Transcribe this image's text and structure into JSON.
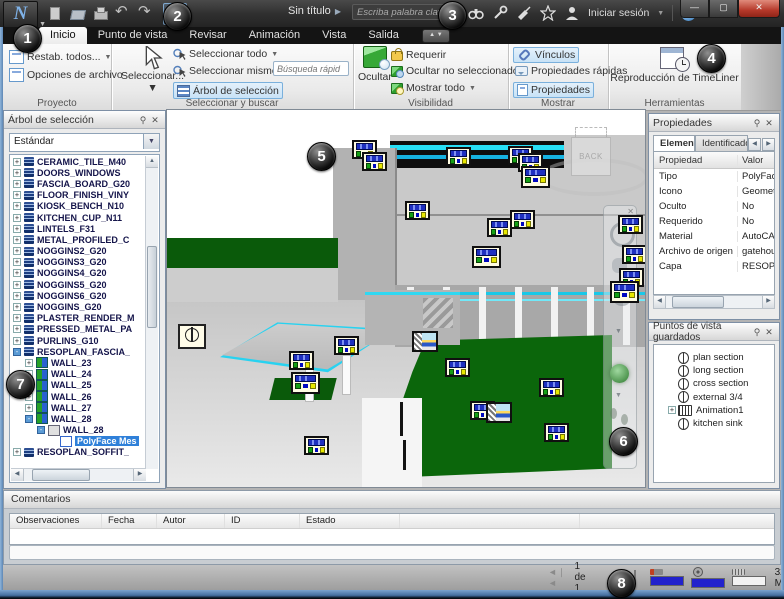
{
  "window": {
    "app_letter": "N"
  },
  "title_bar": {
    "doc_title": "Sin título",
    "search_placeholder": "Escriba palabra clave o frase",
    "sign_in_label": "Iniciar sesión",
    "qat_icons": [
      "new-file",
      "open-file",
      "print",
      "undo",
      "redo"
    ],
    "right_icons": [
      "binoculars",
      "wrench",
      "satellite",
      "star",
      "user",
      "help"
    ]
  },
  "ribbon": {
    "tabs": [
      "Inicio",
      "Punto de vista",
      "Revisar",
      "Animación",
      "Vista",
      "Salida"
    ],
    "active_tab": "Inicio",
    "proyecto": {
      "title": "Proyecto",
      "restab": "Restab. todos...",
      "opciones": "Opciones de archivo"
    },
    "seleccionar": {
      "title": "Seleccionar y buscar",
      "big": "Seleccionar...",
      "todo": "Seleccionar todo",
      "mismo": "Seleccionar mismo",
      "busqueda_placeholder": "Búsqueda rápid",
      "arbol": "Árbol de selección"
    },
    "visibilidad": {
      "title": "Visibilidad",
      "ocultar": "Ocultar",
      "requerir": "Requerir",
      "ocultar_no": "Ocultar no seleccionados",
      "mostrar_todo": "Mostrar todo"
    },
    "mostrar": {
      "title": "Mostrar",
      "vinculos": "Vínculos",
      "prop_rapidas": "Propiedades rápidas",
      "propiedades": "Propiedades"
    },
    "herramientas": {
      "title": "Herramientas",
      "timeliner": "Reproducción de TimeLiner"
    }
  },
  "selection_tree": {
    "title": "Árbol de selección",
    "combo_value": "Estándar",
    "items": [
      {
        "label": "CERAMIC_TILE_M40",
        "level": 1,
        "exp": "+",
        "icon": "layer"
      },
      {
        "label": "DOORS_WINDOWS",
        "level": 1,
        "exp": "+",
        "icon": "layer"
      },
      {
        "label": "FASCIA_BOARD_G20",
        "level": 1,
        "exp": "+",
        "icon": "layer"
      },
      {
        "label": "FLOOR_FINISH_VINY",
        "level": 1,
        "exp": "+",
        "icon": "layer"
      },
      {
        "label": "KIOSK_BENCH_N10",
        "level": 1,
        "exp": "+",
        "icon": "layer"
      },
      {
        "label": "KITCHEN_CUP_N11",
        "level": 1,
        "exp": "+",
        "icon": "layer"
      },
      {
        "label": "LINTELS_F31",
        "level": 1,
        "exp": "+",
        "icon": "layer"
      },
      {
        "label": "METAL_PROFILED_C",
        "level": 1,
        "exp": "+",
        "icon": "layer"
      },
      {
        "label": "NOGGINS2_G20",
        "level": 1,
        "exp": "+",
        "icon": "layer"
      },
      {
        "label": "NOGGINS3_G20",
        "level": 1,
        "exp": "+",
        "icon": "layer"
      },
      {
        "label": "NOGGINS4_G20",
        "level": 1,
        "exp": "+",
        "icon": "layer"
      },
      {
        "label": "NOGGINS5_G20",
        "level": 1,
        "exp": "+",
        "icon": "layer"
      },
      {
        "label": "NOGGINS6_G20",
        "level": 1,
        "exp": "+",
        "icon": "layer"
      },
      {
        "label": "NOGGINS_G20",
        "level": 1,
        "exp": "+",
        "icon": "layer"
      },
      {
        "label": "PLASTER_RENDER_M",
        "level": 1,
        "exp": "+",
        "icon": "layer"
      },
      {
        "label": "PRESSED_METAL_PA",
        "level": 1,
        "exp": "+",
        "icon": "layer"
      },
      {
        "label": "PURLINS_G10",
        "level": 1,
        "exp": "+",
        "icon": "layer"
      },
      {
        "label": "RESOPLAN_FASCIA_",
        "level": 1,
        "exp": "-",
        "icon": "layer"
      },
      {
        "label": "WALL_23",
        "level": 2,
        "exp": "+",
        "icon": "wall"
      },
      {
        "label": "WALL_24",
        "level": 2,
        "exp": "+",
        "icon": "wall"
      },
      {
        "label": "WALL_25",
        "level": 2,
        "exp": "+",
        "icon": "wall"
      },
      {
        "label": "WALL_26",
        "level": 2,
        "exp": "+",
        "icon": "wall"
      },
      {
        "label": "WALL_27",
        "level": 2,
        "exp": "+",
        "icon": "wall"
      },
      {
        "label": "WALL_28",
        "level": 2,
        "exp": "-",
        "icon": "wall"
      },
      {
        "label": "WALL_28",
        "level": 3,
        "exp": "-",
        "icon": "group",
        "bold": true
      },
      {
        "label": "PolyFace Mes",
        "level": 4,
        "exp": "",
        "icon": "geom",
        "sel": true
      },
      {
        "label": "RESOPLAN_SOFFIT_",
        "level": 1,
        "exp": "+",
        "icon": "layer"
      }
    ]
  },
  "properties": {
    "title": "Propiedades",
    "tabs": [
      "Elemento",
      "Identificador d"
    ],
    "columns": [
      "Propiedad",
      "Valor"
    ],
    "rows": [
      [
        "Tipo",
        "PolyFace M"
      ],
      [
        "Icono",
        "Geometría"
      ],
      [
        "Oculto",
        "No"
      ],
      [
        "Requerido",
        "No"
      ],
      [
        "Material",
        "AutoCAD C"
      ],
      [
        "Archivo de origen",
        "gatehouse"
      ],
      [
        "Capa",
        "RESOPLA"
      ]
    ]
  },
  "viewpoints": {
    "title": "Puntos de vista guardados",
    "items": [
      {
        "label": "plan section",
        "icon": "viewpoint",
        "exp": ""
      },
      {
        "label": "long section",
        "icon": "viewpoint",
        "exp": ""
      },
      {
        "label": "cross section",
        "icon": "viewpoint",
        "exp": ""
      },
      {
        "label": "external 3/4",
        "icon": "viewpoint",
        "exp": ""
      },
      {
        "label": "Animation1",
        "icon": "animation",
        "exp": "+"
      },
      {
        "label": "kitchen sink",
        "icon": "viewpoint",
        "exp": ""
      }
    ]
  },
  "comments": {
    "title": "Comentarios",
    "columns": [
      "Observaciones",
      "Fecha",
      "Autor",
      "ID",
      "Estado"
    ]
  },
  "status_bar": {
    "page": "1 de 1",
    "memory": "324 MB"
  },
  "viewport": {
    "viewcube_face": "BACK",
    "link_icons": [
      {
        "x": 352,
        "y": 140,
        "t": "link"
      },
      {
        "x": 362,
        "y": 152,
        "t": "link"
      },
      {
        "x": 446,
        "y": 147,
        "t": "link"
      },
      {
        "x": 508,
        "y": 146,
        "t": "link"
      },
      {
        "x": 518,
        "y": 153,
        "t": "link"
      },
      {
        "x": 521,
        "y": 166,
        "t": "link",
        "big": true
      },
      {
        "x": 405,
        "y": 201,
        "t": "link"
      },
      {
        "x": 510,
        "y": 210,
        "t": "link"
      },
      {
        "x": 487,
        "y": 218,
        "t": "link"
      },
      {
        "x": 472,
        "y": 246,
        "t": "link",
        "big": true
      },
      {
        "x": 618,
        "y": 215,
        "t": "link"
      },
      {
        "x": 622,
        "y": 245,
        "t": "link"
      },
      {
        "x": 619,
        "y": 268,
        "t": "link"
      },
      {
        "x": 610,
        "y": 281,
        "t": "link",
        "big": true
      },
      {
        "x": 334,
        "y": 336,
        "t": "link"
      },
      {
        "x": 289,
        "y": 351,
        "t": "link"
      },
      {
        "x": 291,
        "y": 372,
        "t": "link",
        "big": true
      },
      {
        "x": 304,
        "y": 436,
        "t": "link"
      },
      {
        "x": 412,
        "y": 331,
        "t": "image"
      },
      {
        "x": 445,
        "y": 358,
        "t": "link"
      },
      {
        "x": 539,
        "y": 378,
        "t": "link"
      },
      {
        "x": 470,
        "y": 401,
        "t": "link"
      },
      {
        "x": 486,
        "y": 402,
        "t": "image"
      },
      {
        "x": 544,
        "y": 423,
        "t": "link"
      }
    ]
  },
  "callouts": [
    {
      "n": "1",
      "x": 26,
      "y": 37
    },
    {
      "n": "2",
      "x": 176,
      "y": 15
    },
    {
      "n": "3",
      "x": 451,
      "y": 14
    },
    {
      "n": "4",
      "x": 710,
      "y": 57
    },
    {
      "n": "5",
      "x": 320,
      "y": 155
    },
    {
      "n": "6",
      "x": 622,
      "y": 440
    },
    {
      "n": "7",
      "x": 19,
      "y": 383
    },
    {
      "n": "8",
      "x": 620,
      "y": 582
    }
  ]
}
